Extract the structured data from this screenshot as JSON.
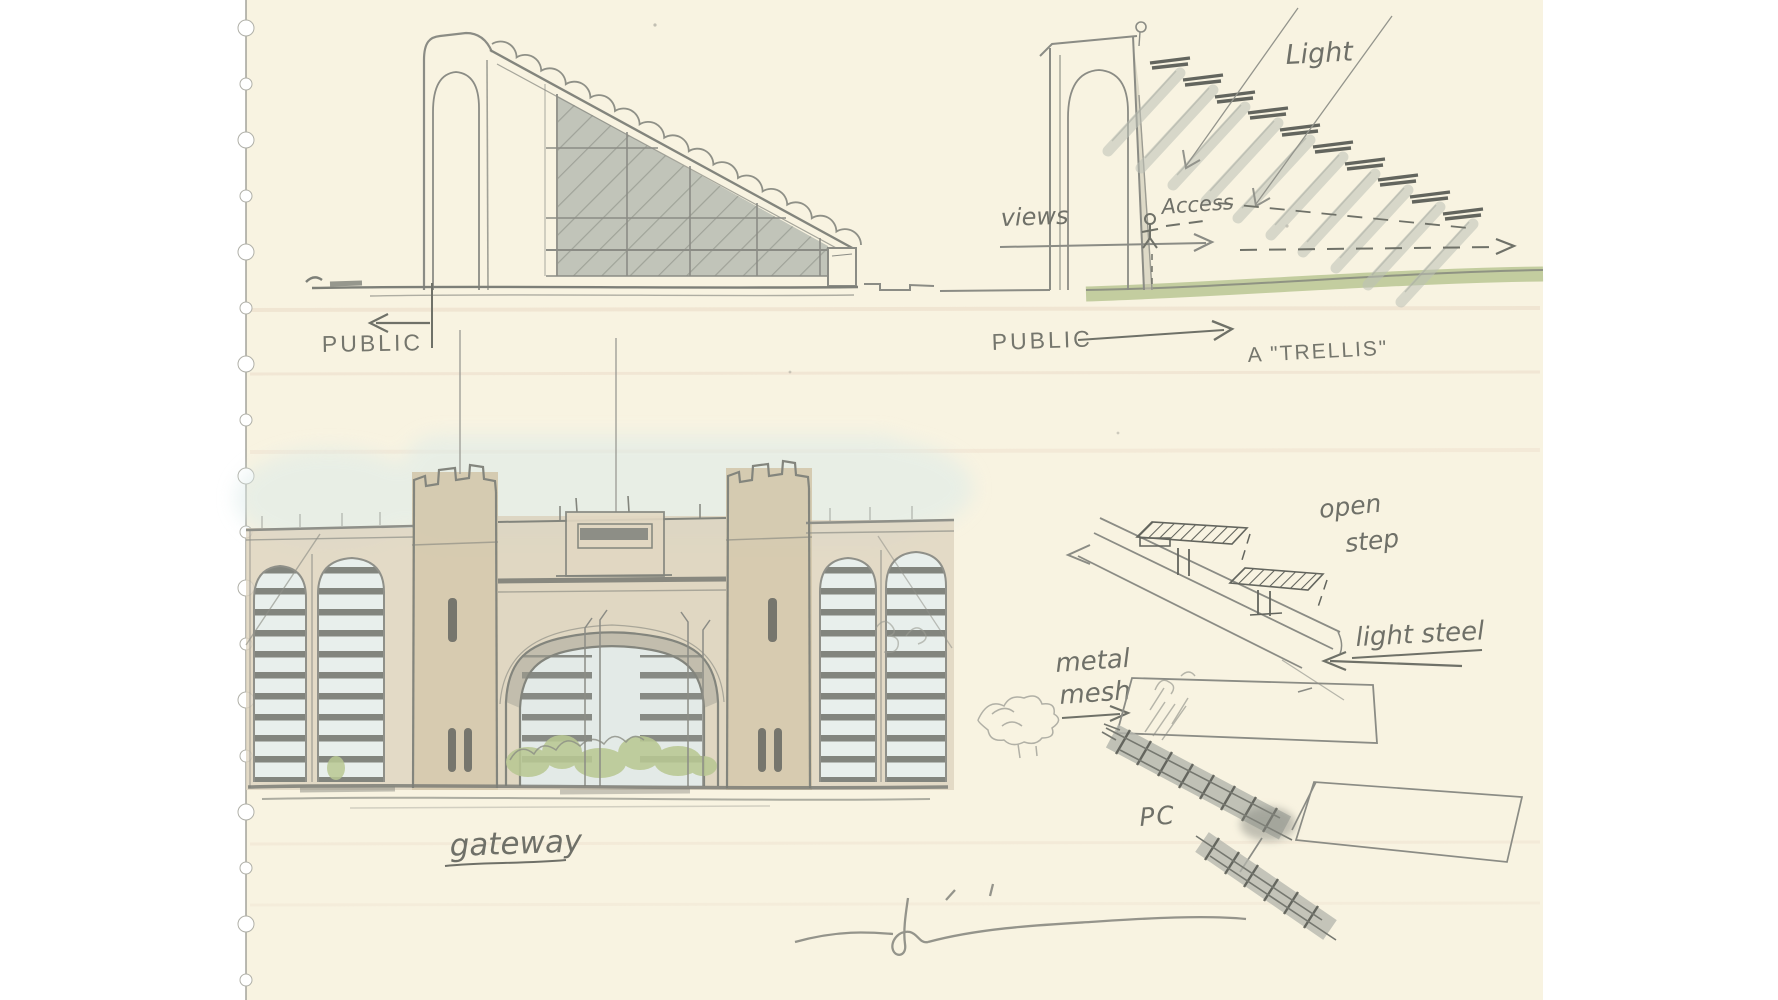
{
  "artwork": {
    "type": "architectural concept sketch",
    "medium": "pencil and watercolor wash on cream sketchbook paper with perforated left edge"
  },
  "palette": {
    "background": "#ffffff",
    "paper": "#f8f3e1",
    "pencil": "#8b8c85",
    "pencil_dark": "#64665f",
    "glass_wash": "#b4bab0",
    "tan_wash": "#d8cdb5",
    "sky_wash": "#dcebe9",
    "ground_green": "#b5c38f",
    "shrub_green": "#b9c893",
    "slat_gray": "#6e706a",
    "handwriting": "#6f7068"
  },
  "section_sketch": {
    "title": "section - tower with sloped glazed trellis roof",
    "label_public": "PUBLIC"
  },
  "trellis_diagram": {
    "title": "light and views diagram through trellis",
    "label_views": "views",
    "label_access": "Access",
    "label_light": "Light",
    "label_public": "PUBLIC",
    "label_trellis": "A \"TRELLIS\""
  },
  "gateway_sketch": {
    "title": "gateway elevation with twin towers and arch",
    "caption": "gateway"
  },
  "detail_sketch": {
    "title": "stair tread details",
    "label_open_1": "open",
    "label_open_2": "step",
    "label_light_steel": "light steel",
    "label_metal_1": "metal",
    "label_metal_2": "mesh",
    "label_pc": "PC"
  }
}
